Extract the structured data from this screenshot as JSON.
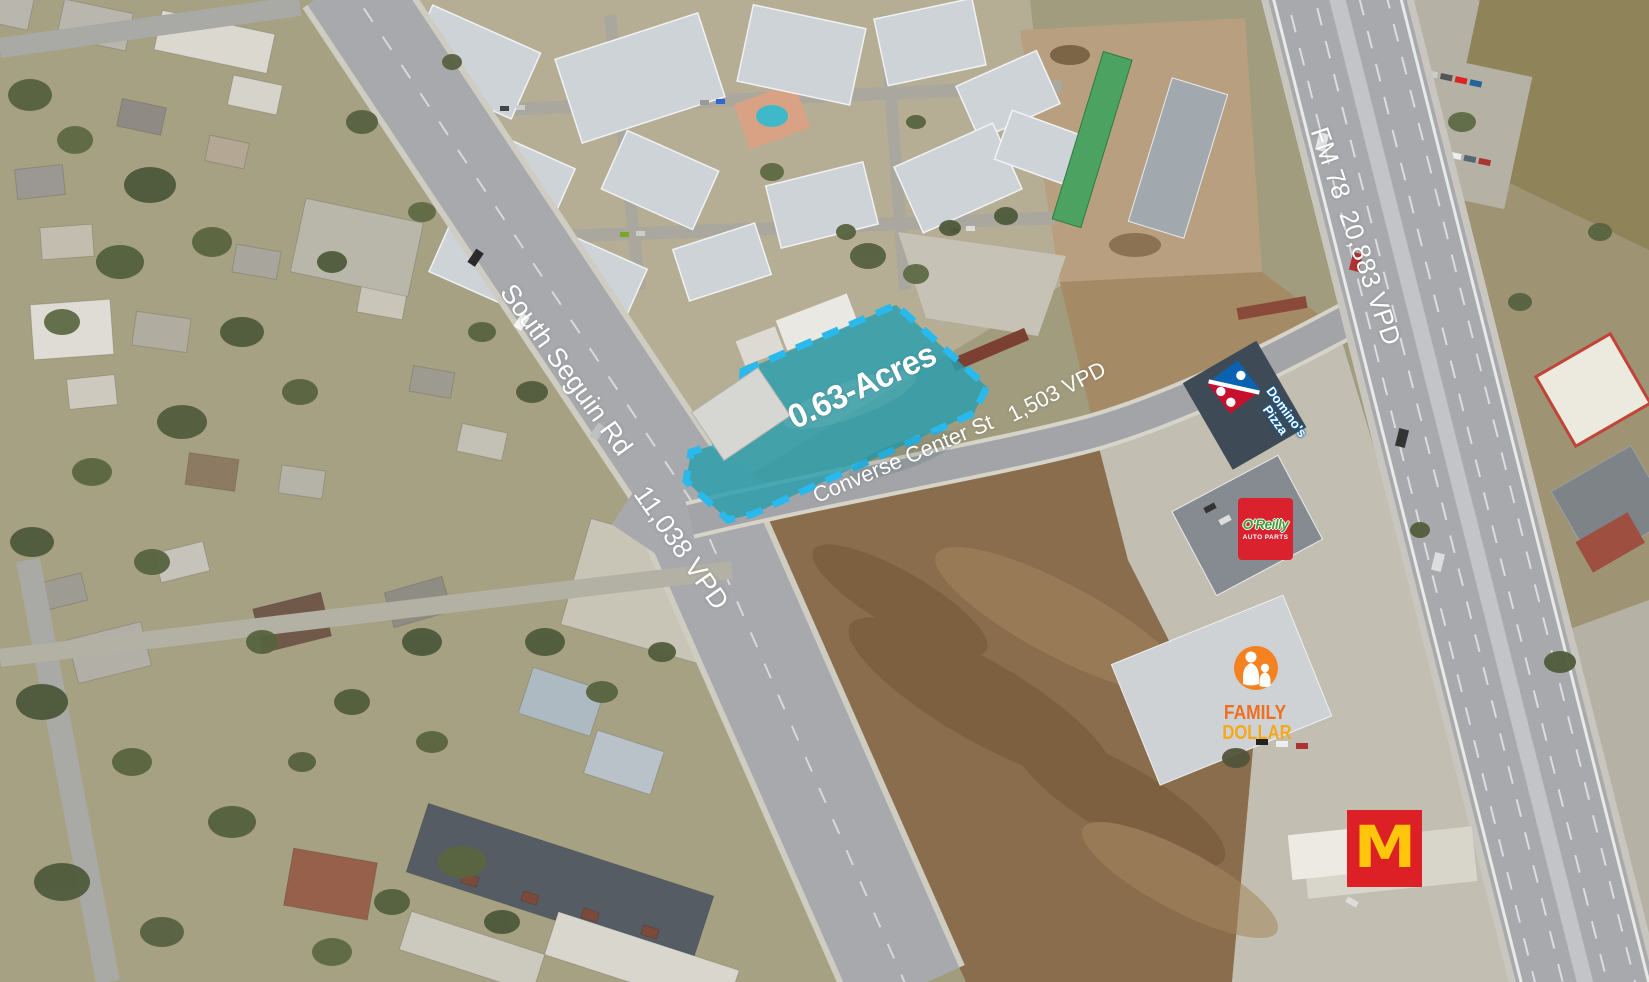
{
  "parcel": {
    "acreage_label": "0.63-Acres",
    "fill_color": "#2A9FAD",
    "border_color": "#29B9EC"
  },
  "roads": {
    "south_seguin": {
      "name": "South Seguin Rd",
      "traffic": "11,038 VPD"
    },
    "converse_center": {
      "name": "Converse Center St",
      "traffic": "1,503 VPD"
    },
    "fm_78": {
      "name_and_traffic": "FM 78  20,883 VPD"
    }
  },
  "businesses": {
    "dominos": {
      "name_line1": "Domino's",
      "name_line2": "Pizza",
      "tile_red": "#C8102E",
      "tile_blue": "#0A63B2"
    },
    "oreilly": {
      "name": "O'Reilly",
      "subtitle": "AUTO PARTS",
      "panel_color": "#D9222E",
      "name_color": "#3F9C35"
    },
    "family_dollar": {
      "word1": "FAMILY",
      "word2": "DOLLAR",
      "word1_color": "#EF6F21",
      "word2_color": "#F6A81C",
      "emblem_color": "#F58220"
    },
    "mcdonalds": {
      "arches_letter": "M",
      "panel_color": "#DD1F26",
      "arches_color": "#FFC60B"
    }
  }
}
